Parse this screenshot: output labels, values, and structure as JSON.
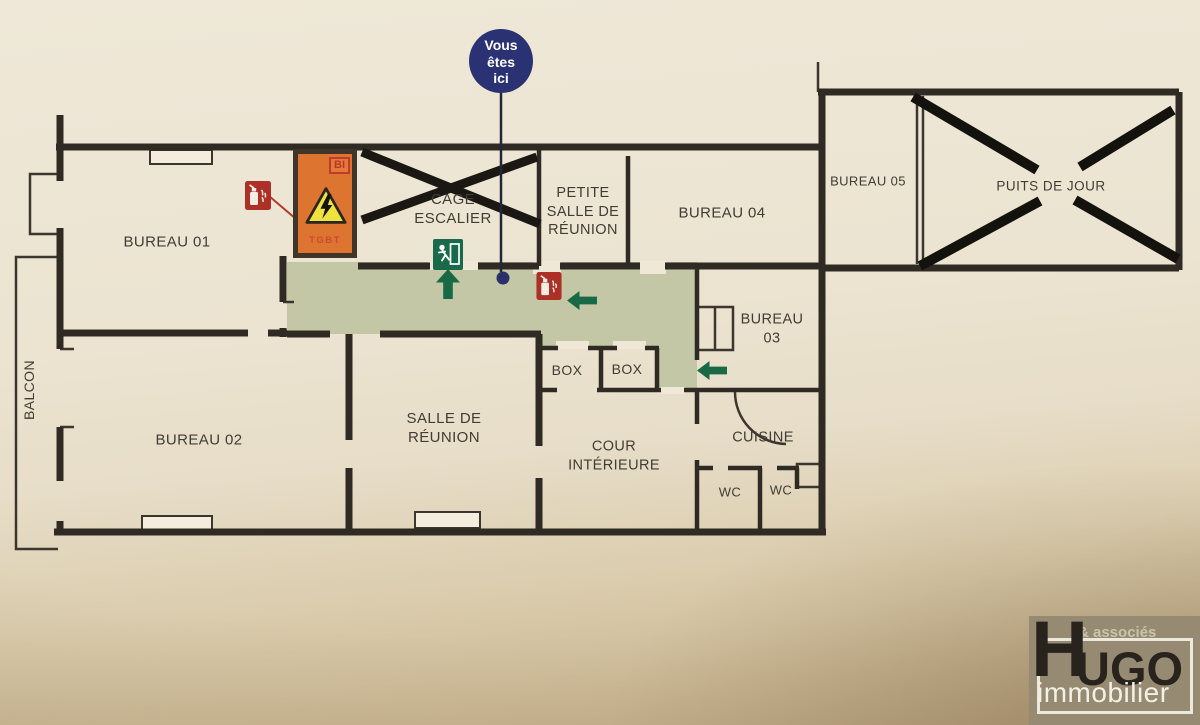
{
  "plan": {
    "badge": {
      "line1": "Vous",
      "line2": "êtes",
      "line3": "ici"
    },
    "rooms": {
      "bureau01": "BUREAU 01",
      "bureau02": "BUREAU 02",
      "bureau03_line1": "BUREAU",
      "bureau03_line2": "03",
      "bureau04": "BUREAU 04",
      "bureau05": "BUREAU 05",
      "puits": "PUITS DE JOUR",
      "cage_line1": "CAGE",
      "cage_line2": "ESCALIER",
      "petite_line1": "PETITE",
      "petite_line2": "SALLE DE",
      "petite_line3": "RÉUNION",
      "salle_line1": "SALLE DE",
      "salle_line2": "RÉUNION",
      "cour_line1": "COUR",
      "cour_line2": "INTÉRIEURE",
      "cuisine": "CUISINE",
      "wc_left": "WC",
      "wc_right": "WC",
      "box_left": "BOX",
      "box_right": "BOX",
      "balcon": "BALCON"
    },
    "technical": {
      "bi": "BI",
      "tgbt": "TGBT"
    },
    "icons": {
      "fire_extinguisher": "fire-extinguisher-icon",
      "emergency_exit": "emergency-exit-icon",
      "electrical_hazard": "electrical-hazard-icon",
      "arrow_up": "arrow-up-icon",
      "arrow_left": "arrow-left-icon",
      "you_are_here": "you-are-here-badge",
      "crossed_out": "crossed-out-mark"
    },
    "colors": {
      "corridor_green": "#c3c7a5",
      "hazard_orange": "#dd7430",
      "safety_green": "#186a46",
      "alarm_red": "#ad3028",
      "badge_navy": "#2b3274",
      "wall": "#2f2b24"
    }
  },
  "logo": {
    "prefix": "& associés",
    "h": "H",
    "ugo": "UGO",
    "suffix": "immobilier"
  }
}
